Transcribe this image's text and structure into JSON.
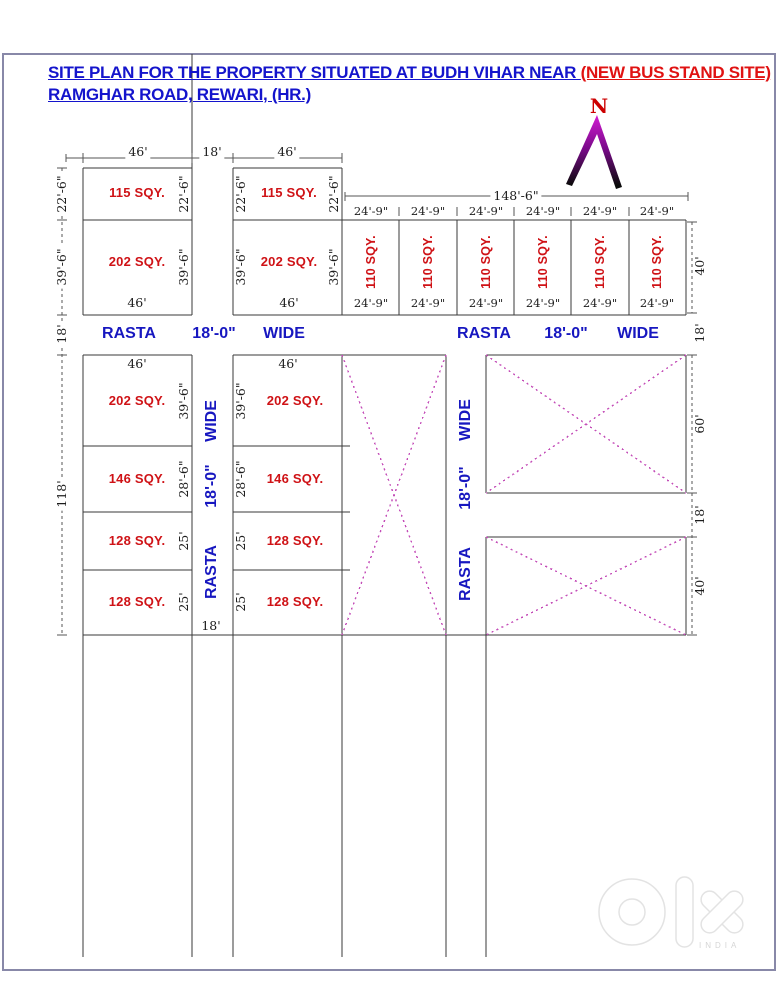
{
  "page": {
    "title_line1_blue": "SITE PLAN FOR THE PROPERTY SITUATED AT BUDH VIHAR NEAR ",
    "title_line1_red": "(NEW BUS STAND SITE)",
    "title_line2": "RAMGHAR ROAD, REWARI, (HR.)"
  },
  "north": {
    "label": "N"
  },
  "dims": {
    "w46": "46'",
    "d18": "18'",
    "d22_6": "22'-6\"",
    "d39_6": "39'-6\"",
    "d28_6": "28'-6\"",
    "d25": "25'",
    "d118": "118'",
    "d148_6": "148'-6\"",
    "d24_9": "24'-9\"",
    "d40": "40'",
    "d60": "60'"
  },
  "plots": {
    "p115": "115 SQY.",
    "p202": "202 SQY.",
    "p110": "110 SQY.",
    "p146": "146 SQY.",
    "p128": "128 SQY."
  },
  "roads": {
    "rasta": "RASTA",
    "width": "18'-0\"",
    "wide": "WIDE"
  },
  "watermark": {
    "brand": "olx",
    "country": "INDIA"
  },
  "colors": {
    "title_blue": "#1414cc",
    "highlight_red": "#e01212",
    "plot_red": "#cf1216",
    "road_blue": "#1717c0",
    "drawing_line": "#3a3a3a",
    "cross_magenta": "#c44eb8",
    "page_border": "#8888a8",
    "north_red": "#cc0000"
  }
}
